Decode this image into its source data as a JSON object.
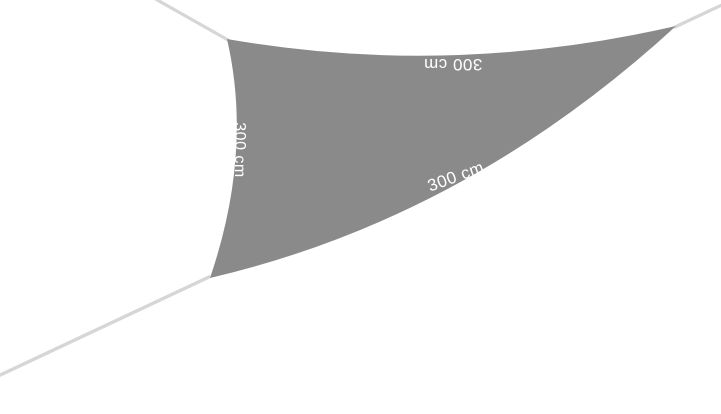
{
  "product_image": {
    "description": "Triangular shade sail stretched by ropes at three corners",
    "background_color": "#ffffff",
    "sail_color": "#8a8a8a",
    "rope_color": "#d6d6d6",
    "label_text_color": "#ffffff",
    "labels": {
      "top_edge": "300 cm",
      "left_edge": "300 cm",
      "bottom_edge": "300 cm"
    }
  }
}
